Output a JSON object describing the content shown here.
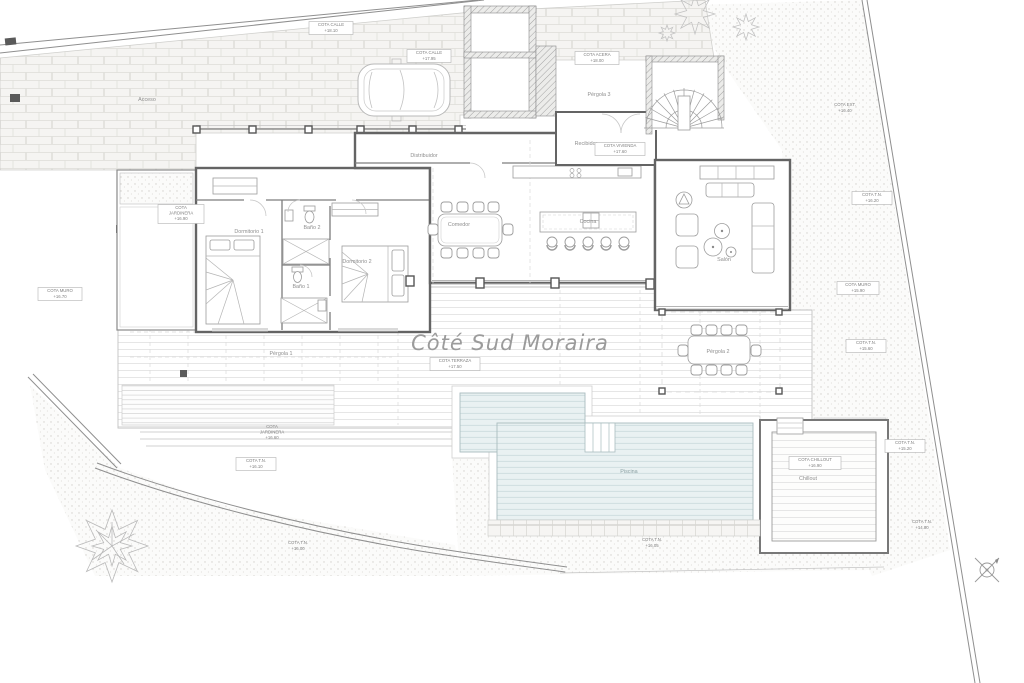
{
  "title": "Côté Sud Moraira",
  "rooms": {
    "dormitorio1": "Dormitorio 1",
    "bano2": "Baño 2",
    "bano1": "Baño 1",
    "dormitorio2": "Dormitorio 2",
    "distribuidor": "Distribuidor",
    "comedor": "Comedor",
    "cocina": "Cocina",
    "salon": "Salón",
    "recibidor": "Recibidor",
    "pergola1": "Pérgola 1",
    "pergola2": "Pérgola 2",
    "pergola3": "Pérgola 3",
    "piscina": "Piscina",
    "chillout": "Chillout",
    "acceso": "Acceso"
  },
  "cotas": {
    "street_a": {
      "l1": "COTA CALLE",
      "l2": "+18.10"
    },
    "street_b": {
      "l1": "COTA CALLE",
      "l2": "+17.95"
    },
    "acera": {
      "l1": "COTA ACERA",
      "l2": "+18.00"
    },
    "vivienda": {
      "l1": "COTA VIVIENDA",
      "l2": "+17.60"
    },
    "terraza": {
      "l1": "COTA TERRAZA",
      "l2": "+17.50"
    },
    "jardinera_w": {
      "l1": "COTA",
      "l2": "JARDINERA",
      "l3": "+16.90"
    },
    "muro_w": {
      "l1": "COTA MURO",
      "l2": "+16.70"
    },
    "ext_e": {
      "l1": "COTA EXT.",
      "l2": "+16.40"
    },
    "tn_e": {
      "l1": "COTA T.N.",
      "l2": "+16.20"
    },
    "muro_e": {
      "l1": "COTA MURO",
      "l2": "+15.90"
    },
    "tn_e2": {
      "l1": "COTA T.N.",
      "l2": "+15.60"
    },
    "jardinera_s": {
      "l1": "COTA",
      "l2": "JARDINERA",
      "l3": "+16.60"
    },
    "tn_sw": {
      "l1": "COTA T.N.",
      "l2": "+16.10"
    },
    "tn_sw2": {
      "l1": "COTA T.N.",
      "l2": "+16.00"
    },
    "tn_s": {
      "l1": "COTA T.N.",
      "l2": "+16.05"
    },
    "chillout": {
      "l1": "COTA CHILLOUT",
      "l2": "+16.90"
    },
    "tn_se": {
      "l1": "COTA T.N.",
      "l2": "+15.20"
    },
    "tn_se2": {
      "l1": "COTA T.N.",
      "l2": "+14.80"
    }
  },
  "colors": {
    "paper": "#ffffff",
    "pool_fill": "#e9f1f2",
    "pool_stripe": "#cfdfe1",
    "wall": "#646464",
    "light_line": "#c9c9c9",
    "title_text": "#9b9b9b"
  }
}
